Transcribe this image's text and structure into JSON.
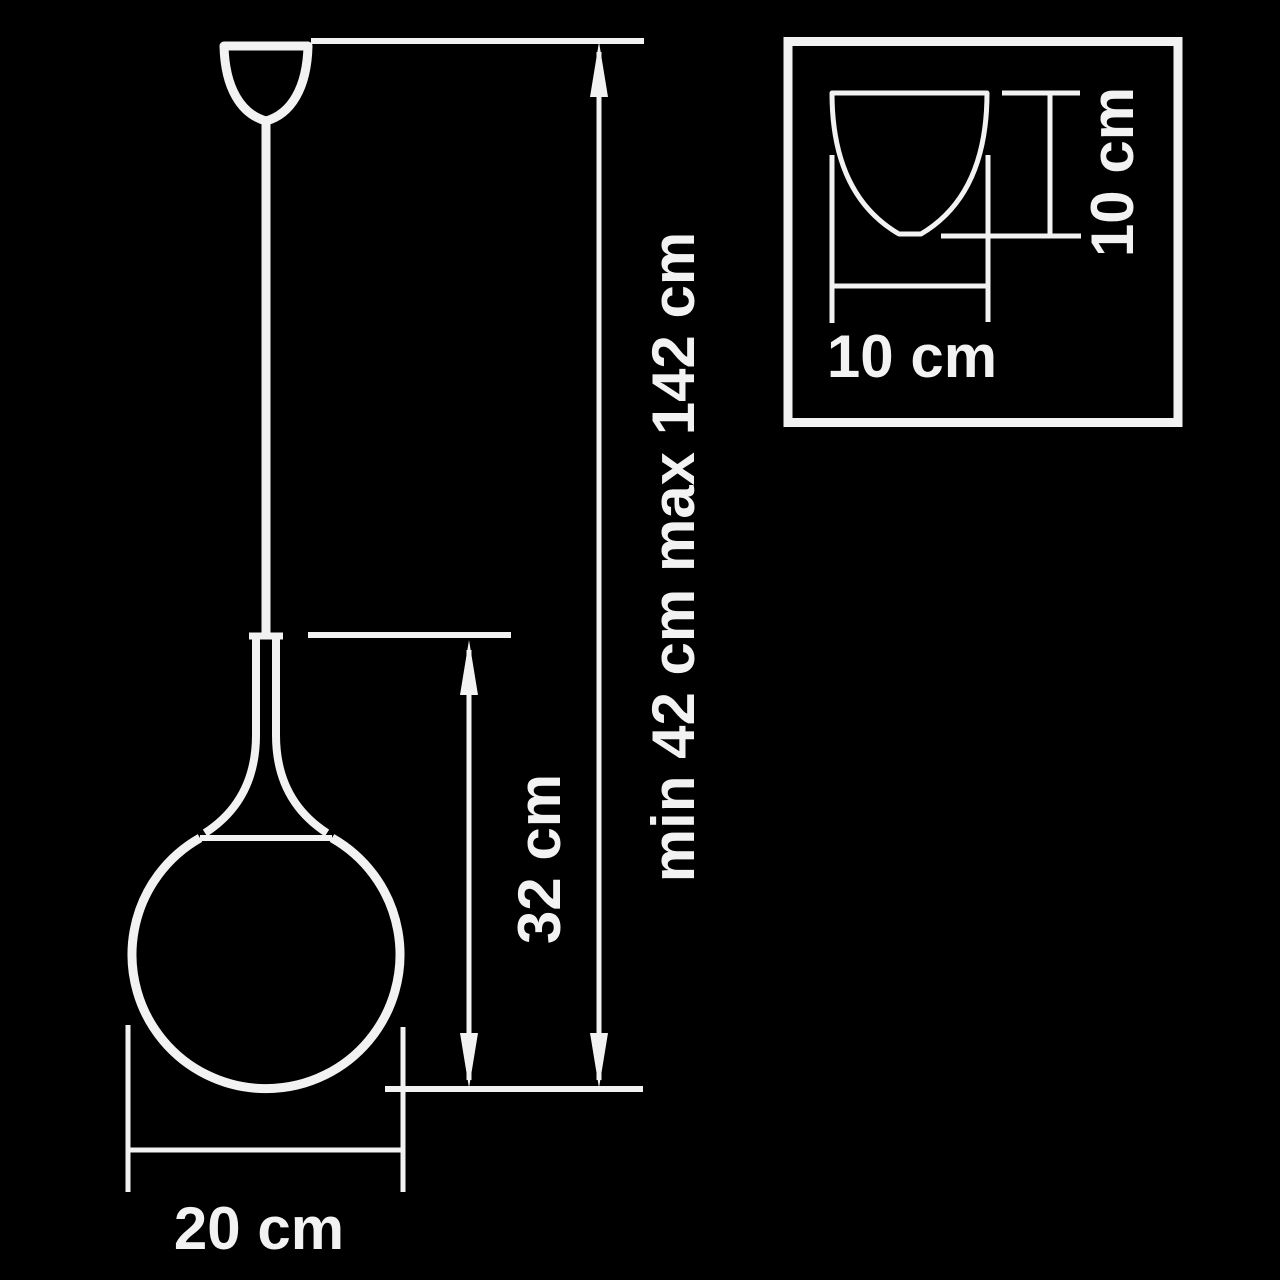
{
  "colors": {
    "background": "#000000",
    "line": "#f2f2f2",
    "text": "#f2f2f2"
  },
  "labels": {
    "total_height": "min 42 cm max 142 cm",
    "shade_height": "32 cm",
    "shade_diameter": "20 cm",
    "canopy_width": "10 cm",
    "canopy_height": "10 cm"
  }
}
